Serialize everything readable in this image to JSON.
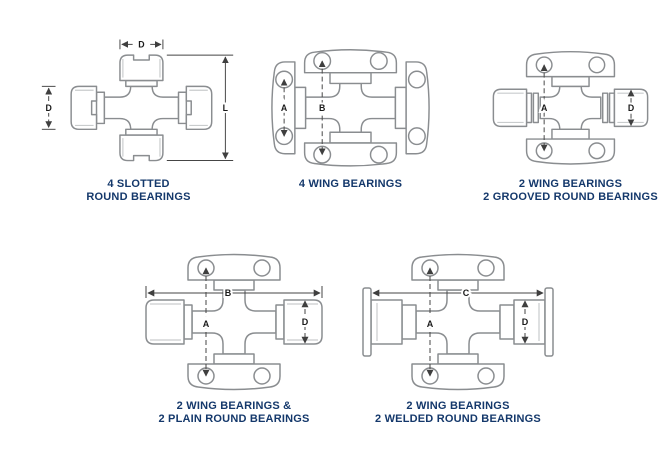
{
  "colors": {
    "background": "#ffffff",
    "caption_text": "#14386b",
    "line_art": "#8a8d90",
    "dimension_lines": "#454545",
    "dimension_text": "#1a1a1a"
  },
  "figures": [
    {
      "caption": [
        "4 SLOTTED",
        "ROUND BEARINGS"
      ],
      "dims": {
        "cap_width": "D",
        "cap_diameter": "D",
        "overall_length": "L"
      }
    },
    {
      "caption": [
        "4 WING BEARINGS"
      ],
      "dims": {
        "wing_hole_span": "A",
        "overall_hole_span": "B"
      }
    },
    {
      "caption": [
        "2 WING BEARINGS",
        "2 GROOVED ROUND BEARINGS"
      ],
      "dims": {
        "hole_span": "A",
        "cap_diameter": "D"
      }
    },
    {
      "caption": [
        "2 WING BEARINGS &",
        "2 PLAIN ROUND BEARINGS"
      ],
      "dims": {
        "overall_width": "B",
        "hole_span": "A",
        "cap_diameter": "D"
      }
    },
    {
      "caption": [
        "2 WING BEARINGS",
        "2 WELDED ROUND BEARINGS"
      ],
      "dims": {
        "overall_width": "C",
        "hole_span": "A",
        "cap_diameter": "D"
      }
    }
  ]
}
